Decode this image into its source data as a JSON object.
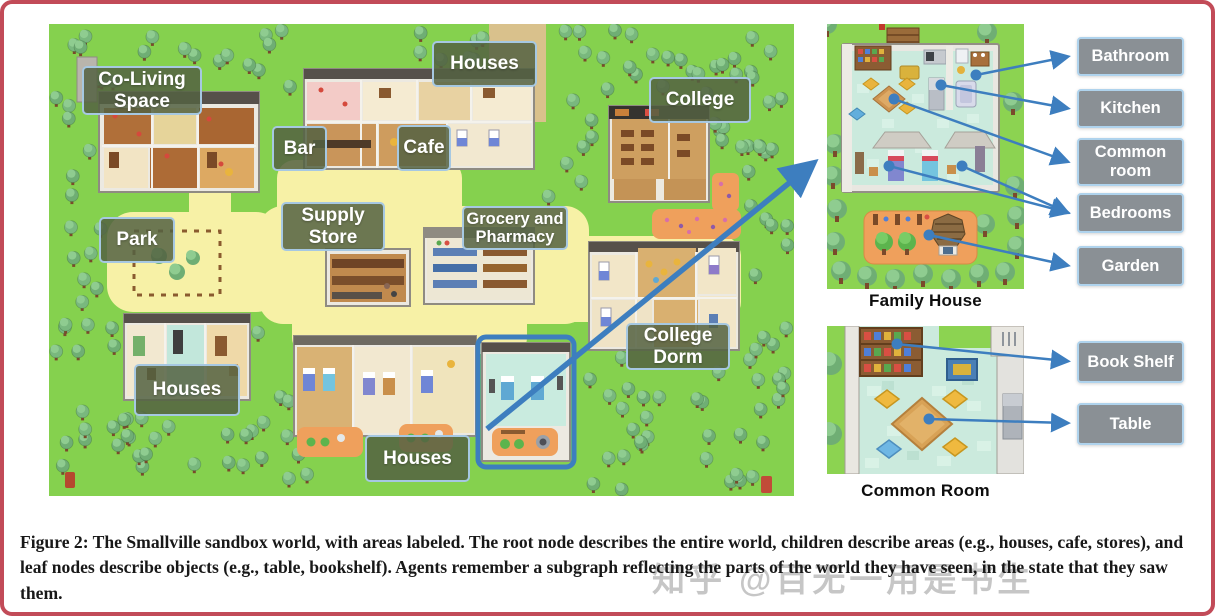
{
  "figure": {
    "caption": "Figure 2: The Smallville sandbox world, with areas labeled. The root node describes the entire world, children describe areas (e.g., houses, cafe, stores), and leaf nodes describe objects (e.g., table, bookshelf). Agents remember a subgraph reflecting the parts of the world they have seen, in the state that they saw them."
  },
  "watermark": "知乎 @百无一用是书生",
  "map": {
    "labels": [
      {
        "id": "co-living-space",
        "label": "Co-Living Space"
      },
      {
        "id": "houses-top",
        "label": "Houses"
      },
      {
        "id": "college",
        "label": "College"
      },
      {
        "id": "bar",
        "label": "Bar"
      },
      {
        "id": "cafe",
        "label": "Cafe"
      },
      {
        "id": "supply-store",
        "label": "Supply Store"
      },
      {
        "id": "grocery-and-pharmacy",
        "label": "Grocery and Pharmacy"
      },
      {
        "id": "park",
        "label": "Park"
      },
      {
        "id": "college-dorm",
        "label": "College Dorm"
      },
      {
        "id": "houses-bottom-left",
        "label": "Houses"
      },
      {
        "id": "houses-bottom-center",
        "label": "Houses"
      }
    ]
  },
  "family_house": {
    "caption": "Family House",
    "labels": [
      "Bathroom",
      "Kitchen",
      "Common room",
      "Bedrooms",
      "Garden"
    ]
  },
  "common_room": {
    "caption": "Common Room",
    "labels": [
      "Book Shelf",
      "Table"
    ]
  },
  "colors": {
    "arrow_blue": "#3d7ebf",
    "map_label_bg": "#536142",
    "detail_label_bg": "#8a9095",
    "label_border": "#afd3ed",
    "frame_border": "#c24b58",
    "grass": "#85d14e",
    "path_yellow": "#f7f1a6"
  }
}
